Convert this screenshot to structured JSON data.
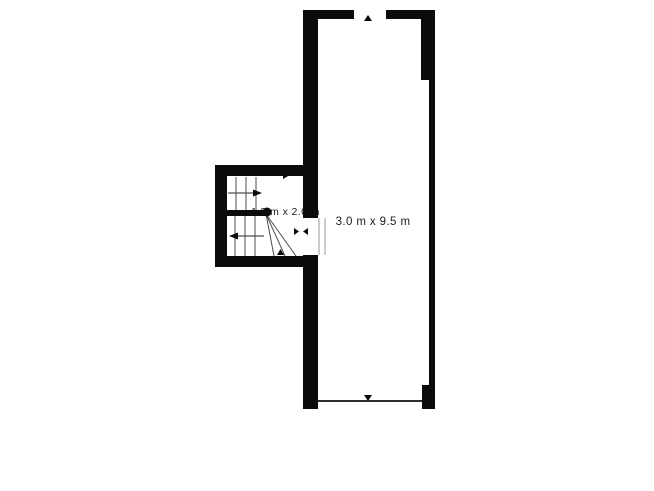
{
  "plan": {
    "type": "floor-plan",
    "rooms": [
      {
        "name": "main-room",
        "label": "3.0 m x 9.5 m"
      },
      {
        "name": "staircase-room",
        "label": "1.9 m x 2.0 m"
      }
    ],
    "markers": [
      {
        "name": "top-window-opening-marker"
      },
      {
        "name": "bottom-window-opening-marker"
      },
      {
        "name": "stair-up-direction-arrow"
      },
      {
        "name": "stair-lower-direction-arrow"
      },
      {
        "name": "doorway-opening-markers"
      },
      {
        "name": "stair-newel-dot"
      }
    ],
    "colors": {
      "wall": "#0b0b0b",
      "stair_line": "#4d4d4d",
      "thin_line": "#2e2e2e",
      "text": "#1c1c1c",
      "background": "#ffffff"
    }
  }
}
